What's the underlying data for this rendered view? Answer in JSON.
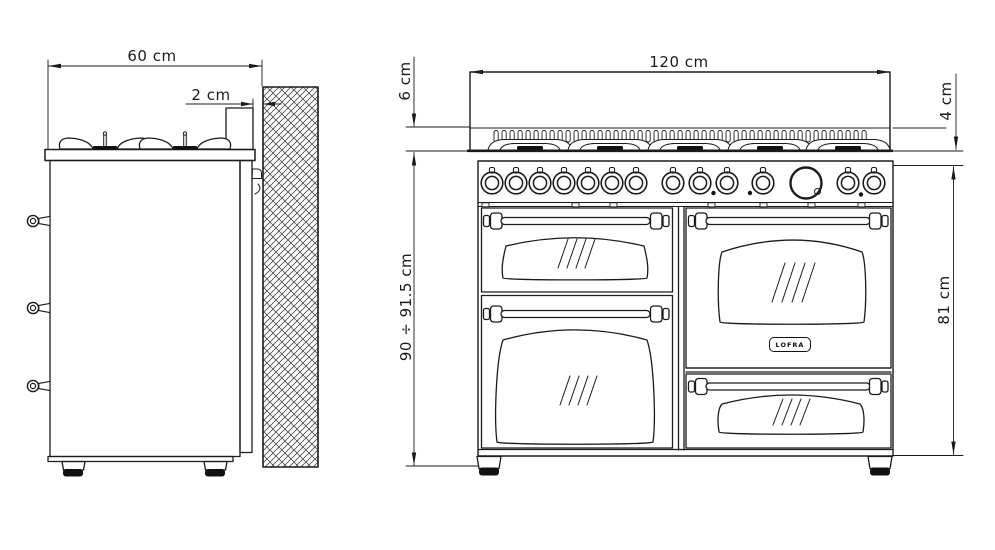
{
  "document": {
    "type": "technical dimension drawing",
    "subject": "120 cm range cooker installation dimensions",
    "views": [
      "side view with wall clearance",
      "front view"
    ]
  },
  "colors": {
    "line": "#1b1b1b",
    "fill": "#111111",
    "background": "#ffffff"
  },
  "side_view": {
    "dim_depth": "60 cm",
    "dim_wall_gap": "2 cm",
    "handle_count": 3,
    "wall_texture": "crosshatch"
  },
  "front_view": {
    "dim_width": "120 cm",
    "dim_upstand": "6 cm",
    "dim_hob_edge": "4 cm",
    "dim_height_total": "90 ÷ 91.5 cm",
    "dim_body_height": "81 cm",
    "knob_count": 14,
    "indicator_dot_count": 3,
    "logo_text": "LOFRA"
  }
}
